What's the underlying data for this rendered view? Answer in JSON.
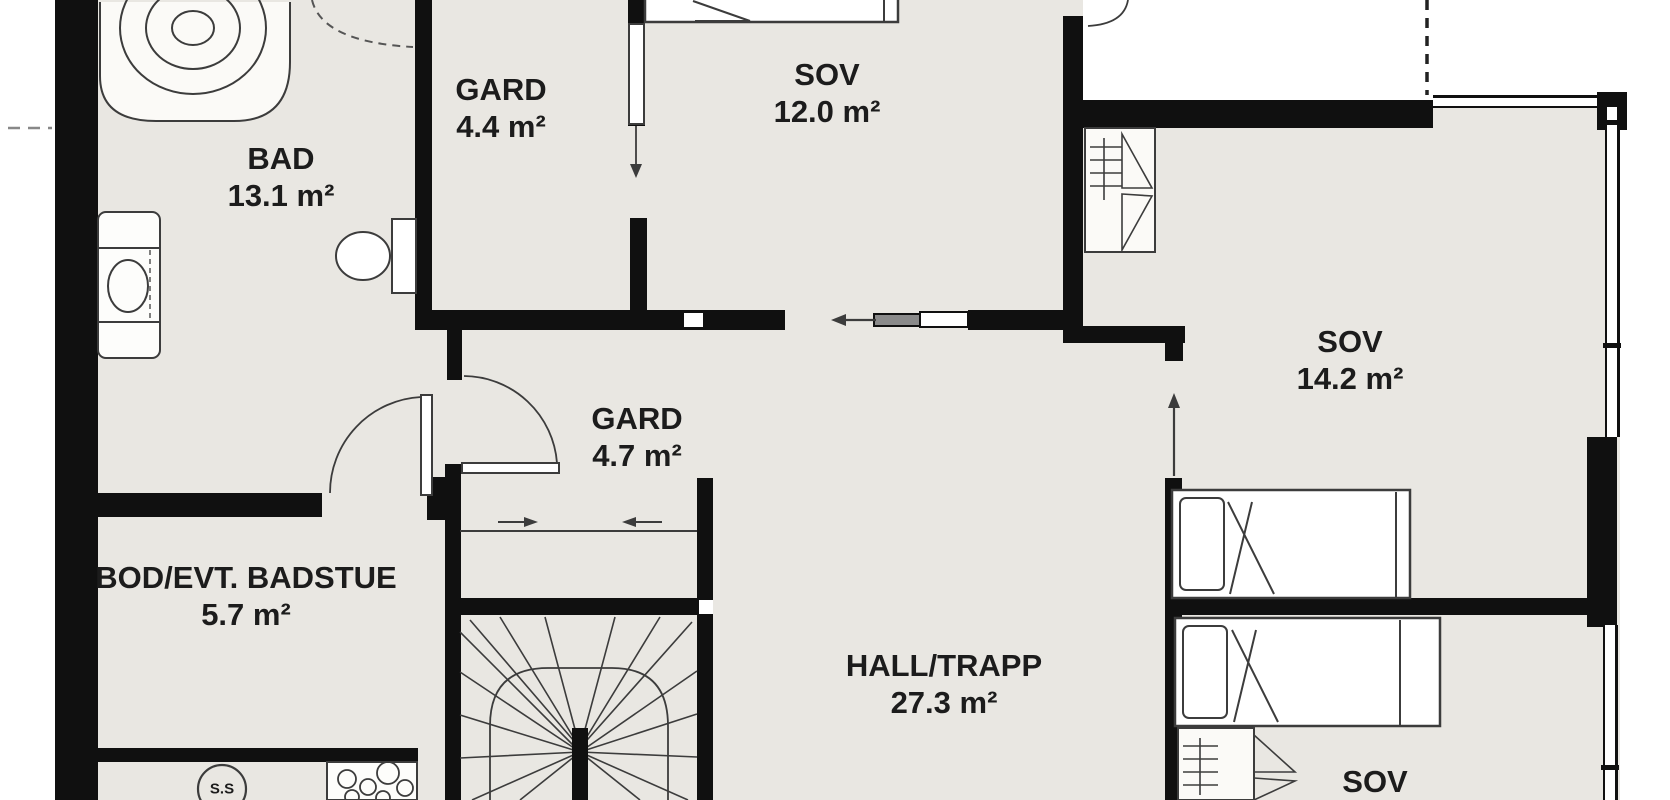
{
  "plan": {
    "rooms": [
      {
        "id": "bad",
        "name": "BAD",
        "area": "13.1 m²"
      },
      {
        "id": "gard-44",
        "name": "GARD",
        "area": "4.4 m²"
      },
      {
        "id": "sov-120",
        "name": "SOV",
        "area": "12.0 m²"
      },
      {
        "id": "sov-142",
        "name": "SOV",
        "area": "14.2 m²"
      },
      {
        "id": "gard-47",
        "name": "GARD",
        "area": "4.7 m²"
      },
      {
        "id": "bod",
        "name": "BOD/EVT. BADSTUE",
        "area": "5.7 m²"
      },
      {
        "id": "hall-trapp",
        "name": "HALL/TRAPP",
        "area": "27.3 m²"
      },
      {
        "id": "sov-bottom",
        "name": "SOV",
        "area": ""
      }
    ],
    "symbols": {
      "sauna_stove_label": "S.S"
    },
    "colors": {
      "wall": "#101010",
      "floor": "#e9e7e2",
      "outside": "#ffffff",
      "furniture_line": "#3c3c3c"
    }
  }
}
